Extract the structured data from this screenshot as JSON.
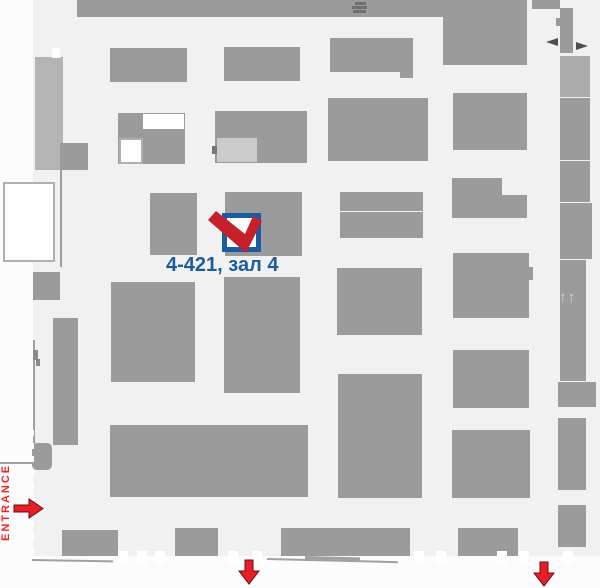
{
  "marker": {
    "label": "4-421, зал 4",
    "check_path": "M3,15 L11,6 L40,29 L48,11 L57,16 L41,48 Z"
  },
  "entrance": {
    "label": "ENTRANCE"
  },
  "stairs_glyph": "↑↑",
  "colors": {
    "floor": "#f1f1f1",
    "outside": "#fcfcfc",
    "booth": "#9b9b9b",
    "booth_light": "#b4b4b4",
    "booth_light2": "#ababab",
    "inner": "#cbcbcb",
    "icon": "#6f6f6f",
    "icon2": "#8a8a8a",
    "dark": "#777777",
    "line": "#a0a0a0",
    "blue": "#1b5b9e",
    "red": "#e8262c",
    "arrow_red": "#e81d25",
    "arrow_stroke": "#6b0d12",
    "glyph_dark": "#4f4f4f"
  },
  "arrows": {
    "entrance": {
      "points": "0,7 15,7 15,1 29,10.5 15,20 15,14 0,14"
    },
    "down1": {
      "points": "7,1 15,1 15,12 21,12 11,25 1,12 7,12"
    },
    "down2": {
      "points": "7,1 15,1 15,12 21,12 11,25 1,12 7,12"
    },
    "passage_left": {
      "points": "12,2 0,6 12,10"
    },
    "passage_right": {
      "points": "2,2 14,6 2,10"
    }
  },
  "blocks": [
    {
      "x": 77,
      "y": 0,
      "w": 450,
      "h": 17,
      "n": "top-wall"
    },
    {
      "x": 355,
      "y": 2,
      "w": 11,
      "h": 3,
      "c": "icon",
      "n": "stage-icon"
    },
    {
      "x": 352,
      "y": 6,
      "w": 15,
      "h": 3,
      "c": "icon",
      "n": "stage-icon"
    },
    {
      "x": 353,
      "y": 10,
      "w": 13,
      "h": 3,
      "c": "icon",
      "n": "stage-icon"
    },
    {
      "x": 443,
      "y": 17,
      "w": 84,
      "h": 48
    },
    {
      "x": 532,
      "y": 0,
      "w": 28,
      "h": 9
    },
    {
      "x": 560,
      "y": 8,
      "w": 13,
      "h": 45
    },
    {
      "x": 556,
      "y": 18,
      "w": 4,
      "h": 8
    },
    {
      "x": 560,
      "y": 56,
      "w": 30,
      "h": 41,
      "c": "booth_light2"
    },
    {
      "x": 560,
      "y": 98,
      "w": 30,
      "h": 62
    },
    {
      "x": 560,
      "y": 161,
      "w": 30,
      "h": 41
    },
    {
      "x": 560,
      "y": 203,
      "w": 32,
      "h": 56
    },
    {
      "x": 560,
      "y": 260,
      "w": 26,
      "h": 121
    },
    {
      "x": 558,
      "y": 382,
      "w": 38,
      "h": 25
    },
    {
      "x": 558,
      "y": 418,
      "w": 28,
      "h": 72
    },
    {
      "x": 558,
      "y": 505,
      "w": 28,
      "h": 42
    },
    {
      "x": 35,
      "y": 57,
      "w": 28,
      "h": 113,
      "c": "booth_light"
    },
    {
      "x": 60,
      "y": 143,
      "w": 28,
      "h": 27
    },
    {
      "x": 33,
      "y": 272,
      "w": 27,
      "h": 28
    },
    {
      "x": 32,
      "y": 443,
      "w": 20,
      "h": 27,
      "r": 5
    },
    {
      "x": 53,
      "y": 318,
      "w": 25,
      "h": 127
    },
    {
      "x": 110,
      "y": 48,
      "w": 77,
      "h": 34
    },
    {
      "x": 224,
      "y": 47,
      "w": 76,
      "h": 34
    },
    {
      "x": 330,
      "y": 38,
      "w": 70,
      "h": 34
    },
    {
      "x": 400,
      "y": 38,
      "w": 13,
      "h": 40
    },
    {
      "x": 400,
      "y": 98,
      "w": 28,
      "h": 63
    },
    {
      "x": 328,
      "y": 98,
      "w": 74,
      "h": 63
    },
    {
      "x": 453,
      "y": 93,
      "w": 74,
      "h": 57
    },
    {
      "x": 118,
      "y": 113,
      "w": 67,
      "h": 51
    },
    {
      "x": 215,
      "y": 111,
      "w": 92,
      "h": 52
    },
    {
      "x": 217,
      "y": 138,
      "w": 40,
      "h": 24,
      "c": "inner",
      "n": "inner-area"
    },
    {
      "x": 212,
      "y": 146,
      "w": 5,
      "h": 8,
      "c": "dark",
      "n": "door-mark"
    },
    {
      "x": 150,
      "y": 193,
      "w": 47,
      "h": 62
    },
    {
      "x": 225,
      "y": 192,
      "w": 77,
      "h": 64
    },
    {
      "x": 340,
      "y": 192,
      "w": 83,
      "h": 19
    },
    {
      "x": 340,
      "y": 212,
      "w": 83,
      "h": 26
    },
    {
      "x": 452,
      "y": 178,
      "w": 50,
      "h": 40
    },
    {
      "x": 502,
      "y": 195,
      "w": 25,
      "h": 23
    },
    {
      "x": 111,
      "y": 282,
      "w": 84,
      "h": 100
    },
    {
      "x": 224,
      "y": 277,
      "w": 76,
      "h": 116
    },
    {
      "x": 337,
      "y": 268,
      "w": 85,
      "h": 67
    },
    {
      "x": 453,
      "y": 253,
      "w": 76,
      "h": 65
    },
    {
      "x": 529,
      "y": 267,
      "w": 4,
      "h": 13
    },
    {
      "x": 338,
      "y": 374,
      "w": 84,
      "h": 124
    },
    {
      "x": 453,
      "y": 350,
      "w": 76,
      "h": 58
    },
    {
      "x": 110,
      "y": 425,
      "w": 198,
      "h": 72
    },
    {
      "x": 452,
      "y": 430,
      "w": 78,
      "h": 68
    },
    {
      "x": 62,
      "y": 530,
      "w": 56,
      "h": 26
    },
    {
      "x": 175,
      "y": 528,
      "w": 43,
      "h": 28
    },
    {
      "x": 281,
      "y": 528,
      "w": 129,
      "h": 28
    },
    {
      "x": 458,
      "y": 528,
      "w": 60,
      "h": 28
    },
    {
      "x": 60,
      "y": 170,
      "w": 2,
      "h": 97,
      "c": "line",
      "n": "wall-line"
    },
    {
      "x": 33,
      "y": 340,
      "w": 2,
      "h": 108,
      "c": "line",
      "n": "wall-line"
    },
    {
      "x": 0,
      "y": 462,
      "w": 33,
      "h": 2,
      "c": "line",
      "n": "wall-line"
    },
    {
      "x": 32,
      "y": 559,
      "w": 81,
      "h": 2,
      "c": "line",
      "rot": 1,
      "n": "wall-line"
    },
    {
      "x": 267,
      "y": 558,
      "w": 131,
      "h": 2,
      "c": "line",
      "rot": 1.4,
      "n": "wall-line"
    },
    {
      "x": 305,
      "y": 556,
      "w": 55,
      "h": 3,
      "c": "line",
      "rot": 1.4,
      "n": "wall-line"
    },
    {
      "x": 33,
      "y": 350,
      "w": 5,
      "h": 10,
      "c": "icon2",
      "n": "door-mark"
    },
    {
      "x": 36,
      "y": 359,
      "w": 4,
      "h": 7,
      "c": "icon2",
      "n": "door-mark"
    }
  ],
  "overlays": [
    {
      "x": 143,
      "y": 114,
      "w": 41,
      "h": 15
    },
    {
      "x": 119,
      "y": 138,
      "w": 24,
      "h": 26,
      "border": true
    },
    {
      "x": 3,
      "y": 182,
      "w": 52,
      "h": 80,
      "border": true
    },
    {
      "x": 52,
      "y": 48,
      "w": 8,
      "h": 10
    }
  ],
  "ticks": {
    "y": 551,
    "w": 10,
    "h": 13,
    "xs": [
      118,
      137,
      155,
      228,
      252,
      414,
      436,
      497,
      519,
      563
    ]
  }
}
